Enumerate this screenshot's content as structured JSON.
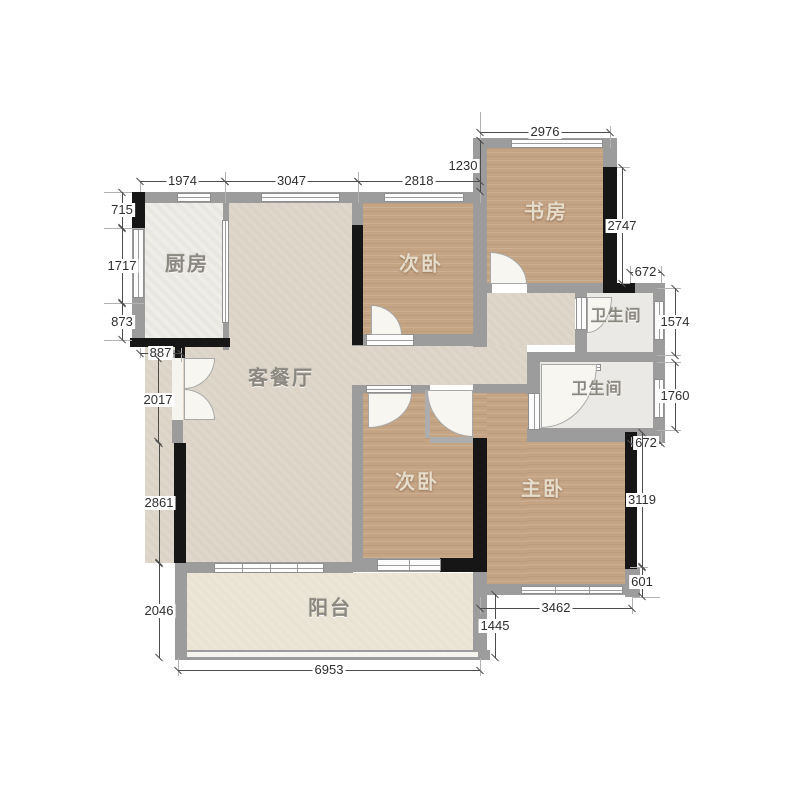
{
  "rooms": {
    "kitchen": "厨房",
    "living_dining": "客餐厅",
    "bedroom_top": "次卧",
    "study": "书房",
    "bath_upper": "卫生间",
    "bath_lower": "卫生间",
    "bedroom_bottom": "次卧",
    "master": "主卧",
    "balcony": "阳台"
  },
  "dims": {
    "d1974": "1974",
    "d3047": "3047",
    "d2818": "2818",
    "d2976": "2976",
    "d1230": "1230",
    "d715": "715",
    "d1717": "1717",
    "d873": "873",
    "d887": "887",
    "d2017": "2017",
    "d2861": "2861",
    "d2046": "2046",
    "d6953": "6953",
    "d3462": "3462",
    "d1445": "1445",
    "d2747": "2747",
    "d672a": "672",
    "d1574": "1574",
    "d1760": "1760",
    "d672b": "672",
    "d3119": "3119",
    "d601": "601"
  },
  "colors": {
    "wood": "#c5a484",
    "floor_light": "#dbd3c5",
    "wall_gray": "#9c9c9c",
    "wall_black": "#161616",
    "dimension_text": "#2e2e2e"
  }
}
